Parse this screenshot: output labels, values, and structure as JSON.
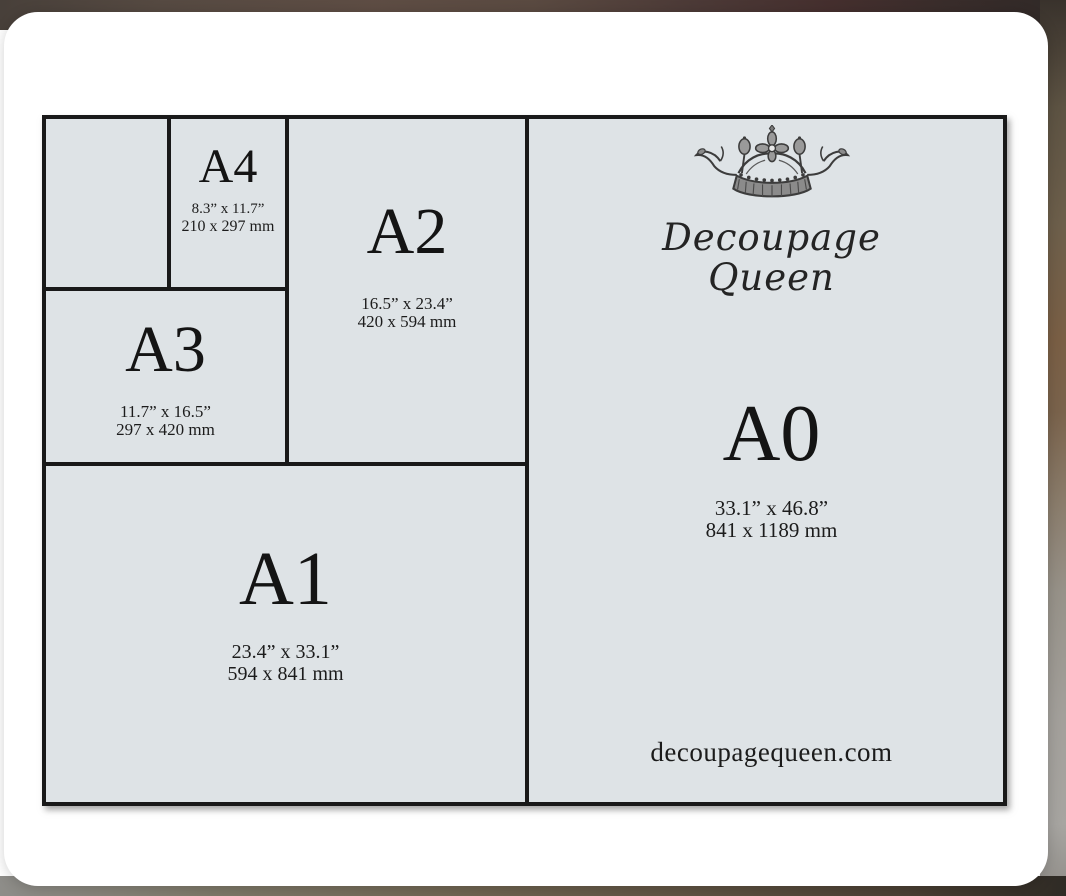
{
  "diagram": {
    "sizes": [
      {
        "label": "A4",
        "inches": "8.3” x 11.7”",
        "mm": "210 x 297 mm"
      },
      {
        "label": "A3",
        "inches": "11.7” x 16.5”",
        "mm": "297 x 420 mm"
      },
      {
        "label": "A2",
        "inches": "16.5” x 23.4”",
        "mm": "420 x 594 mm"
      },
      {
        "label": "A1",
        "inches": "23.4” x 33.1”",
        "mm": "594 x 841 mm"
      },
      {
        "label": "A0",
        "inches": "33.1” x 46.8”",
        "mm": "841 x 1189 mm"
      }
    ],
    "brand": {
      "name_line1": "Decoupage",
      "name_line2": "Queen",
      "logo": "crown-icon"
    },
    "website": "decoupagequeen.com",
    "colors": {
      "paper_background": "#dee3e6",
      "line": "#191919",
      "card_background": "#ffffff",
      "text": "#161616"
    }
  }
}
